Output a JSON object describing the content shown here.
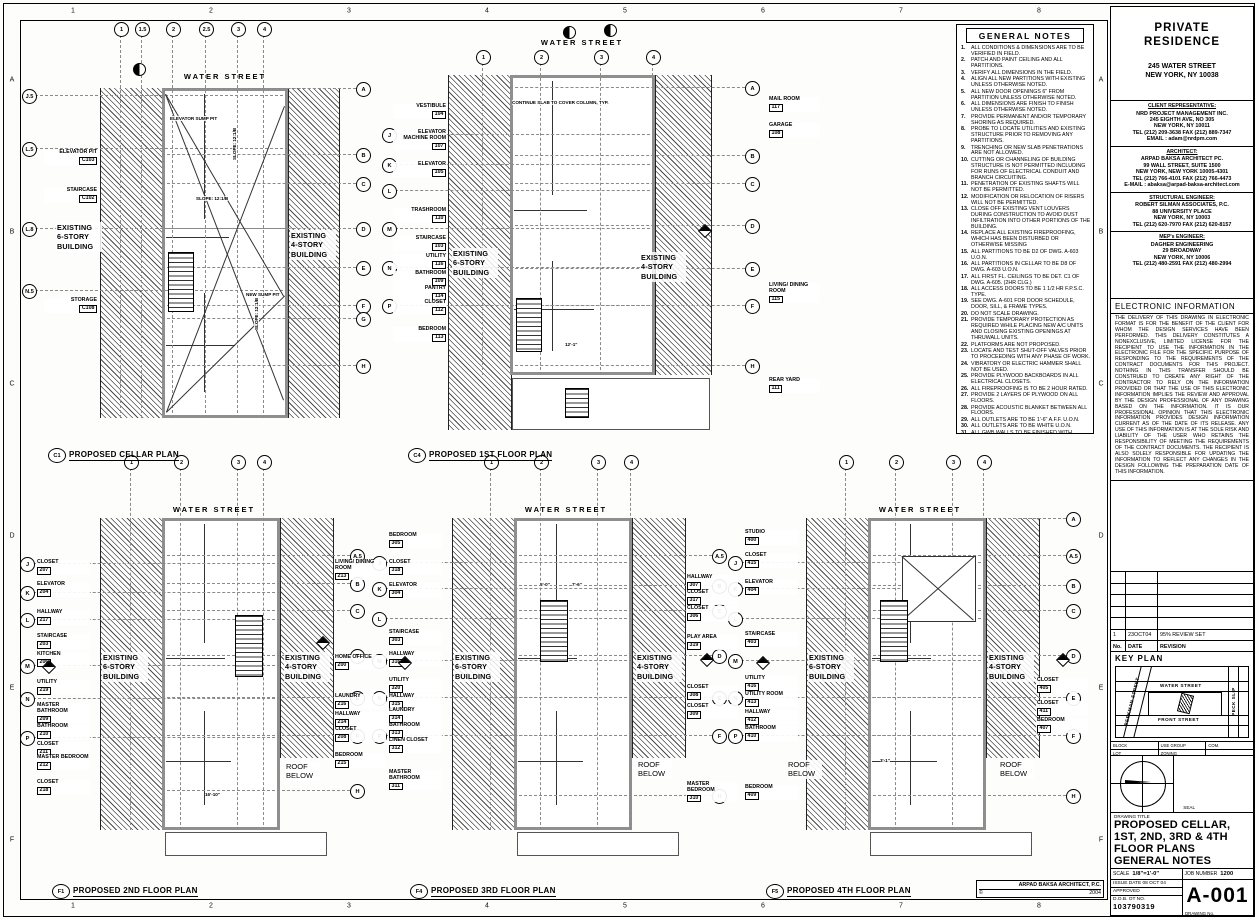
{
  "sheet": {
    "margin_numbers": [
      "1",
      "2",
      "3",
      "4",
      "5",
      "6",
      "7",
      "8"
    ],
    "margin_letters": [
      "A",
      "B",
      "C",
      "D",
      "E",
      "F"
    ],
    "credit": {
      "firm": "ARPAD BAKSA ARCHITECT, P.C.",
      "copyright": "©",
      "year": "2004"
    }
  },
  "general_notes": {
    "title": "GENERAL NOTES",
    "items": [
      "ALL CONDITIONS & DIMENSIONS ARE TO BE VERIFIED IN FIELD.",
      "PATCH AND PAINT CEILING AND ALL PARTITIONS.",
      "VERIFY ALL DIMENSIONS IN THE FIELD.",
      "ALIGN ALL NEW PARTITIONS WITH EXISTING UNLESS OTHERWISE NOTED.",
      "ALL NEW DOOR OPENINGS 6\" FROM PARTITION UNLESS OTHERWISE NOTED.",
      "ALL DIMENSIONS ARE FINISH TO FINISH UNLESS OTHERWISE NOTED.",
      "PROVIDE PERMANENT AND/OR TEMPORARY SHORING AS REQUIRED.",
      "PROBE TO LOCATE UTILITIES AND EXISTING STRUCTURE PRIOR TO REMOVING ANY PARTITIONS.",
      "TRENCHING OR NEW SLAB PENETRATIONS ARE NOT ALLOWED.",
      "CUTTING OR CHANNELING OF BUILDING STRUCTURE IS NOT PERMITTED INCLUDING FOR RUNS OF ELECTRICAL CONDUIT AND BRANCH CIRCUITING.",
      "PENETRATION OF EXISTING SHAFTS WILL NOT BE PERMITTED.",
      "MODIFICATION OR RELOCATION OF RISERS WILL NOT BE PERMITTED.",
      "CLOSE OFF EXISTING VENT LOUVERS DURING CONSTRUCTION TO AVOID DUST INFILTRATION INTO OTHER PORTIONS OF THE BUILDING.",
      "REPLACE ALL EXISTING FIREPROOFING, WHICH HAS BEEN DISTURBED OR OTHERWISE MISSING",
      "ALL PARTITIONS TO BE D2 OF DWG. A-603 U.O.N.",
      "ALL PARTITIONS IN CELLAR TO BE D8 OF DWG. A-603 U.O.N.",
      "ALL FIRST FL. CEILINGS TO BE DET. C1 OF DWG. A-605. (2HR CLG.)",
      "ALL ACCESS DOORS TO BE 1 1/2 HR F.P.S.C. TYPE.",
      "SEE DWG. A-601 FOR DOOR SCHEDULE, DOOR, SILL, & FRAME TYPES.",
      "DO NOT SCALE DRAWING.",
      "PROVIDE TEMPORARY PROTECTION AS REQUIRED WHILE PLACING NEW A/C UNITS AND CLOSING EXISTING OPENINGS AT THRUWALL UNITS.",
      "PLATFORMS ARE NOT PROPOSED.",
      "LOCATE AND TEST SHUT-OFF VALVES PRIOR TO PROCEEDING WITH ANY PHASE OF WORK.",
      "VIBRATORY OR ELECTRIC HAMMER SHALL NOT BE USED.",
      "PROVIDE PLYWOOD BACKBOARDS IN ALL ELECTRICAL CLOSETS.",
      "ALL FIREPROOFING IS TO BE 2 HOUR RATED.",
      "PROVIDE 2 LAYERS OF PLYWOOD ON ALL FLOORS.",
      "PROVIDE ACOUSTIC BLANKET BETWEEN ALL FLOORS.",
      "ALL OUTLETS ARE TO BE 1'-6\" A.F.F. U.O.N.",
      "ALL OUTLETS ARE TO BE WHITE U.O.N.",
      "ALL GWB WALLS TO BE FINISHED WITH ROUGH PLASTER FINISH TYP. U.O.N. ARCHITECT TO APPROVE SAMPLE.",
      "ALL EXTERIOR BRICK WALLS TO REMAIN AS EXPOSED BRICK FINISH.  CLEAN AND REPAIR EXISTING BRICK, REMOVE ALL PAINT, MISC BOLTS/SCREWS, ETC.",
      "ALL INTERIOR EXPOSED BRICK TO BE SANDBLASTED, POINTED AND SEALED"
    ]
  },
  "title_block": {
    "project": {
      "line1": "PRIVATE",
      "line2": "RESIDENCE",
      "address1": "245 WATER STREET",
      "address2": "NEW YORK, NY  10038"
    },
    "contacts": [
      {
        "heading": "CLIENT REPRESENTATIVE:",
        "lines": [
          "NRD PROJECT MANAGEMENT INC.",
          "245 EIGHTH AVE, NO 305",
          "NEW YORK, NY 10011",
          "TEL (212) 209-3638 FAX (212) 889-7347",
          "EMAIL : adam@nrdpm.com"
        ]
      },
      {
        "heading": "ARCHITECT:",
        "lines": [
          "ARPAD BAKSA ARCHITECT PC.",
          "99 WALL STREET, SUITE 1500",
          "NEW YORK, NEW YORK 10005-4301",
          "TEL (212) 766-4101 FAX (212) 766-4473",
          "E-MAIL : abaksa@arpad-baksa-architect.com"
        ]
      },
      {
        "heading": "STRUCTURAL ENGINEER:",
        "lines": [
          "ROBERT SILMAN ASSOCIATES, P.C.",
          "88 UNIVERSITY PLACE",
          "NEW YORK, NY 10003",
          "TEL (212) 620-7970 FAX (212) 620-8157"
        ]
      },
      {
        "heading": "MEP's ENGINEER:",
        "lines": [
          "DAGHER ENGINEERING",
          "29 BROADWAY",
          "NEW YORK, NY  10006",
          "TEL (212) 480-2591 FAX (212) 480-2994"
        ]
      }
    ],
    "electronic": {
      "title": "ELECTRONIC INFORMATION",
      "body": "THE DELIVERY OF THIS DRAWING IN ELECTRONIC FORMAT IS FOR THE BENEFIT OF THE CLIENT FOR WHOM THE DESIGN SERVICES HAVE BEEN PERFORMED.  THIS DELIVERY CONSTITUTES A NONEXCLUSIVE, LIMITED LICENSE FOR THE RECIPIENT TO USE THE INFORMATION IN THE ELECTRONIC FILE FOR THE SPECIFIC PURPOSE OF RESPONDING TO THE REQUIREMENTS OF THE CONTRACT DOCUMENTS FOR THIS PROJECT.  NOTHING IN THIS TRANSFER SHOULD BE CONSTRUED TO CREATE ANY RIGHT OF THE CONTRACTOR TO RELY ON THE INFORMATION PROVIDED OR THAT THE USE OF THIS ELECTRONIC INFORMATION IMPLIES THE REVIEW AND APPROVAL BY THE DESIGN PROFESSIONAL OF ANY DRAWING BASED ON THE INFORMATION.  IT IS OUR PROFESSIONAL OPINION THAT THIS ELECTRONIC INFORMATION PROVIDES DESIGN INFORMATION CURRENT AS OF THE DATE OF ITS RELEASE.  ANY USE OF THIS INFORMATION IS AT THE SOLE RISK AND LIABILITY OF THE USER WHO RETAINS THE RESPONSIBILITY OF MEETING THE REQUIREMENTS OF THE CONTRACT DOCUMENTS.  THE RECIPIENT IS ALSO SOLELY RESPONSIBLE FOR UPDATING THE INFORMATION TO REFLECT ANY CHANGES IN THE DESIGN FOLLOWING THE PREPARATION DATE OF THIS INFORMATION."
    },
    "revisions": {
      "header": [
        "No.",
        "DATE",
        "REVISION"
      ],
      "rows": [
        [
          "1",
          "23OCT04",
          "95% REVIEW SET"
        ]
      ],
      "empty_rows": 5
    },
    "key_plan": {
      "title": "KEY PLAN",
      "street_top": "WATER STREET",
      "street_bottom": "FRONT STREET",
      "street_left": "BEEKMAN STREET",
      "street_right": "PECK SLIP"
    },
    "zoning_rows": [
      [
        "BLOCK",
        "USE GROUP",
        "COM."
      ],
      [
        "LOT",
        "ZONING",
        ""
      ]
    ],
    "seal_label": "SEAL",
    "drawing_title": {
      "label": "DRAWING TITLE",
      "lines": [
        "PROPOSED CELLAR,",
        "1ST, 2ND, 3RD & 4TH",
        "FLOOR PLANS",
        "GENERAL NOTES"
      ]
    },
    "fields": {
      "scale_label": "SCALE",
      "scale": "1/8\"=1'-0\"",
      "job_label": "JOB NUMBER",
      "job": "1200",
      "issue_label": "ISSUE DATE",
      "issue": "08 OCT 04",
      "approved_label": "APPROVED",
      "dob_label": "D.O.B. OT NO.",
      "dob": "103790319",
      "drawing_no_label": "DRAWING No.",
      "drawing_no": "A-001"
    }
  },
  "plans": [
    {
      "id": "cellar",
      "tag": "C1",
      "title": "PROPOSED CELLAR PLAN",
      "street": "WATER STREET",
      "top_bubbles": [
        "1",
        "1.5",
        "2",
        "2.5",
        "3",
        "4"
      ],
      "left_bubbles": [
        "J.5",
        "L.5",
        "L.8",
        "N.5"
      ],
      "right_bubbles": [
        "A",
        "B",
        "C",
        "D",
        "E",
        "F",
        "G",
        "H"
      ],
      "left_rooms": [
        {
          "name": "ELEVATOR PIT",
          "num": "C103"
        },
        {
          "name": "STAIRCASE",
          "num": "C102"
        },
        {
          "name": "STORAGE",
          "num": "C108"
        }
      ],
      "right_rooms": [],
      "left_building": "EXISTING 6-STORY BUILDING",
      "right_building": "EXISTING 4-STORY BUILDING",
      "roof_below": "",
      "annotations": [
        "ELEVATOR SUMP PIT",
        "NEW SUMP PIT",
        "SLOPE: 12:1/B"
      ]
    },
    {
      "id": "first",
      "tag": "C4",
      "title": "PROPOSED 1ST FLOOR PLAN",
      "street": "WATER STREET",
      "top_bubbles": [
        "1",
        "2",
        "3",
        "4"
      ],
      "left_bubbles": [
        "J",
        "K",
        "L",
        "M",
        "N",
        "P"
      ],
      "right_bubbles": [
        "A",
        "B",
        "C",
        "D",
        "E",
        "F",
        "H"
      ],
      "left_rooms": [
        {
          "name": "VESTIBULE",
          "num": "104"
        },
        {
          "name": "ELEVATOR MACHINE ROOM",
          "num": "107"
        },
        {
          "name": "ELEVATOR",
          "num": "105"
        },
        {
          "name": "TRASHROOM",
          "num": "110"
        },
        {
          "name": "STAIRCASE",
          "num": "103"
        },
        {
          "name": "UTILITY",
          "num": "116"
        },
        {
          "name": "BATHROOM",
          "num": "109"
        },
        {
          "name": "PANTRY",
          "num": "114"
        },
        {
          "name": "CLOSET",
          "num": "112"
        },
        {
          "name": "BEDROOM",
          "num": "113"
        }
      ],
      "right_rooms": [
        {
          "name": "MAIL ROOM",
          "num": "117"
        },
        {
          "name": "GARAGE",
          "num": "108"
        },
        {
          "name": "LIVING/ DINING ROOM",
          "num": "115"
        },
        {
          "name": "REAR YARD",
          "num": "111"
        }
      ],
      "left_building": "EXISTING 6-STORY BUILDING",
      "right_building": "EXISTING 4-STORY BUILDING",
      "roof_below": "",
      "annotations": [
        "CONTINUE SLAB TO COVER COLUMN, TYP.",
        "12'-1\""
      ]
    },
    {
      "id": "second",
      "tag": "F1",
      "title": "PROPOSED 2ND FLOOR PLAN",
      "street": "WATER STREET",
      "top_bubbles": [
        "1",
        "2",
        "3",
        "4"
      ],
      "left_bubbles": [
        "J",
        "K",
        "L",
        "M",
        "N",
        "P"
      ],
      "right_bubbles": [
        "A.5",
        "B",
        "C",
        "D",
        "E",
        "F",
        "H"
      ],
      "left_rooms": [
        {
          "name": "CLOSET",
          "num": "207"
        },
        {
          "name": "ELEVATOR",
          "num": "204"
        },
        {
          "name": "HALLWAY",
          "num": "217"
        },
        {
          "name": "STAIRCASE",
          "num": "203"
        },
        {
          "name": "KITCHEN",
          "num": "206"
        },
        {
          "name": "UTILITY",
          "num": "219"
        },
        {
          "name": "MASTER BATHROOM",
          "num": "209"
        },
        {
          "name": "BATHROOM",
          "num": "210"
        },
        {
          "name": "CLOSET",
          "num": "211"
        },
        {
          "name": "MASTER BEDROOM",
          "num": "212"
        },
        {
          "name": "CLOSET",
          "num": "218"
        }
      ],
      "right_rooms": [
        {
          "name": "LIVING/ DINING ROOM",
          "num": "213"
        },
        {
          "name": "HOME OFFICE",
          "num": "200"
        },
        {
          "name": "LAUNDRY",
          "num": "216"
        },
        {
          "name": "HALLWAY",
          "num": "214"
        },
        {
          "name": "CLOSET",
          "num": "208"
        },
        {
          "name": "BEDROOM",
          "num": "215"
        }
      ],
      "left_building": "EXISTING 6-STORY BUILDING",
      "right_building": "EXISTING 4-STORY BUILDING",
      "roof_below": "ROOF BELOW",
      "annotations": [
        "16'-10\""
      ]
    },
    {
      "id": "third",
      "tag": "F4",
      "title": "PROPOSED 3RD FLOOR PLAN",
      "street": "WATER STREET",
      "top_bubbles": [
        "1",
        "2",
        "3",
        "4"
      ],
      "left_bubbles": [
        "J",
        "K",
        "L",
        "M",
        "N",
        "P"
      ],
      "right_bubbles": [
        "A.5",
        "B",
        "C",
        "D",
        "E",
        "F",
        "H"
      ],
      "left_rooms": [
        {
          "name": "BEDROOM",
          "num": "305"
        },
        {
          "name": "CLOSET",
          "num": "318"
        },
        {
          "name": "ELEVATOR",
          "num": "304"
        },
        {
          "name": "STAIRCASE",
          "num": "303"
        },
        {
          "name": "HALLWAY",
          "num": "316"
        },
        {
          "name": "UTILITY",
          "num": "320"
        },
        {
          "name": "HALLWAY",
          "num": "315"
        },
        {
          "name": "LAUNDRY",
          "num": "314"
        },
        {
          "name": "BATHROOM",
          "num": "313"
        },
        {
          "name": "LINEN CLOSET",
          "num": "312"
        },
        {
          "name": "MASTER BATHROOM",
          "num": "311"
        }
      ],
      "right_rooms": [
        {
          "name": "HALLWAY",
          "num": "307"
        },
        {
          "name": "CLOSET",
          "num": "317"
        },
        {
          "name": "CLOSET",
          "num": "306"
        },
        {
          "name": "PLAY AREA",
          "num": "319"
        },
        {
          "name": "CLOSET",
          "num": "308"
        },
        {
          "name": "CLOSET",
          "num": "309"
        },
        {
          "name": "MASTER BEDROOM",
          "num": "310"
        }
      ],
      "left_building": "EXISTING 6-STORY BUILDING",
      "right_building": "EXISTING 4-STORY BUILDING",
      "roof_below": "ROOF BELOW",
      "annotations": [
        "5'-0\"",
        "7'-6\""
      ]
    },
    {
      "id": "fourth",
      "tag": "F5",
      "title": "PROPOSED 4TH FLOOR PLAN",
      "street": "WATER STREET",
      "top_bubbles": [
        "1",
        "2",
        "3",
        "4"
      ],
      "left_bubbles": [
        "J",
        "K",
        "L",
        "M",
        "N",
        "P"
      ],
      "right_bubbles": [
        "A",
        "A.5",
        "B",
        "C",
        "D",
        "E",
        "F",
        "H"
      ],
      "left_rooms": [
        {
          "name": "STUDIO",
          "num": "400"
        },
        {
          "name": "CLOSET",
          "num": "415"
        },
        {
          "name": "ELEVATOR",
          "num": "404"
        },
        {
          "name": "STAIRCASE",
          "num": "403"
        },
        {
          "name": "UTILITY",
          "num": "416"
        },
        {
          "name": "UTILITY ROOM",
          "num": "413"
        },
        {
          "name": "HALLWAY",
          "num": "412"
        },
        {
          "name": "BATHROOM",
          "num": "410"
        },
        {
          "name": "BEDROOM",
          "num": "409"
        }
      ],
      "right_rooms": [
        {
          "name": "CLOSET",
          "num": "405"
        },
        {
          "name": "CLOSET",
          "num": "411"
        },
        {
          "name": "BEDROOM",
          "num": "407"
        }
      ],
      "left_building": "EXISTING 6-STORY BUILDING",
      "right_building": "EXISTING 4-STORY BUILDING",
      "roof_below": "ROOF BELOW",
      "annotations": [
        "3'-1\""
      ]
    }
  ]
}
